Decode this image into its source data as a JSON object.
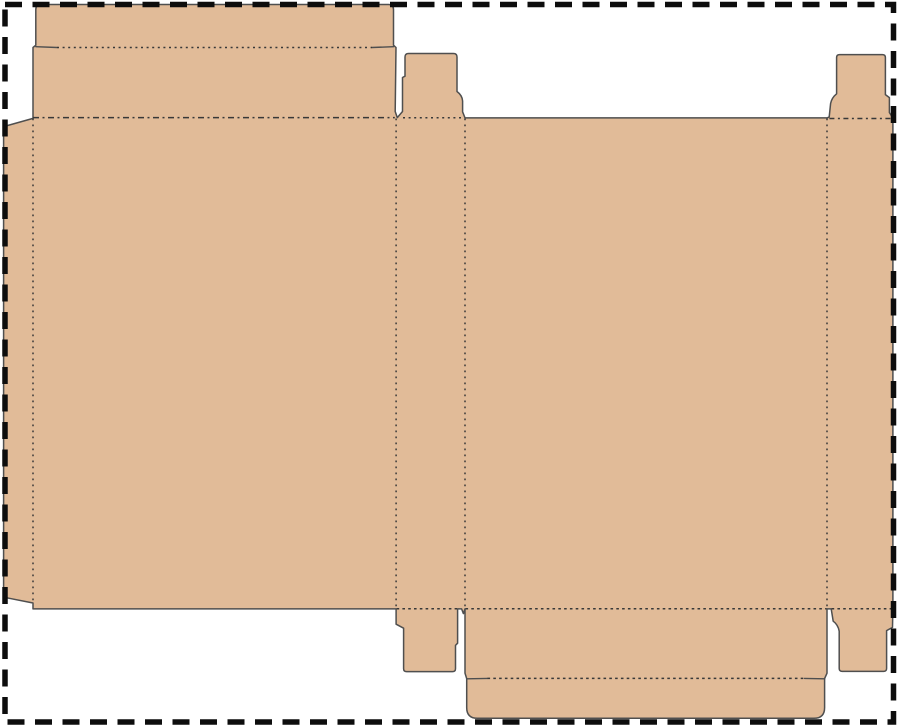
{
  "diagram": {
    "name": "folding-carton-dieline-template",
    "canvas": {
      "width": 900,
      "height": 727,
      "background": "#ffffff"
    },
    "colors": {
      "board_fill": "#E1BB98",
      "cut_line": "#4f4f4f",
      "crease_line": "#383838",
      "page_border": "#0d0d0d"
    },
    "page_border": {
      "x": 5,
      "y": 4.5,
      "width": 888.5,
      "height": 717.5,
      "stroke_width": 5.5,
      "dash": "17 10.5"
    },
    "outline": {
      "name": "dieline-cut-outline",
      "path": "M33,47.5 L35.8,45.2 L35.8,9.5 Q35.8,4.5 40.8,4.5 L388.5,4.5 Q393.5,4.5 393.5,9.5 L393.5,45.2 L396,47.5 L395.2,111.5 L397.3,117.6 L402.5,111.5 L402.5,77.5 L405,76.2 L405,57 Q405,53.5 408.5,53.5 L453.5,53.5 Q457,53.5 457,57 L457,91.5 Q462.3,95.4 462.6,101 L462.6,111.8 L465,117.9 L827,117.9 L829.2,117 L830.6,103.5 Q831.8,97.6 836.6,93.8 L836.6,57.5 Q836.6,54.6 839.6,54.6 L882.4,54.6 Q885.4,54.6 885.4,57.5 L885.4,94.6 L889.4,97.6 L889.4,112.6 L892.9,117.9 L892.9,607.6 L892.5,627.4 L886.6,630.6 L886.6,668.4 Q886.6,671.4 883.6,671.4 L842.2,671.4 Q839.2,671.4 839.2,668.4 L839.2,631.2 Q838,624.6 833.2,621.2 L831.2,608.9 L827,608.9 L827,673.2 L824.6,678.6 L824.6,707.6 Q824.6,718.3 813.9,718.3 L477.4,718.3 Q466.7,718.3 466.7,707.6 L466.7,678.6 L465,673.2 L465,608.9 L463.4,613.6 L461.6,608.9 L457.6,608.9 L457.6,643.2 L455.5,645.4 L455.5,668.6 Q455.5,671.6 452.5,671.6 L406.6,671.6 Q403.6,671.6 403.6,668.6 L403.6,628.2 L396.1,624.2 L396.1,608.9 L33,608.9 L33,603 L3.6,597.2 L3.6,126.6 L33,118.4 Z"
    },
    "solid_stubs": [
      {
        "name": "crease-stub-top-left",
        "path": "M35.8,46.7 L57,47.5"
      },
      {
        "name": "crease-stub-top-right",
        "path": "M372,47.5 L393.5,46.7"
      },
      {
        "name": "crease-stub-tuck-left",
        "path": "M466.7,678.8 L487.5,678.4"
      },
      {
        "name": "crease-stub-tuck-right",
        "path": "M804.5,678.4 L824.6,678.8"
      }
    ],
    "crease_lines": [
      {
        "name": "crease-top-tuck-flap",
        "path": "M57,47.5 L372,47.5",
        "dash": "2 3.6"
      },
      {
        "name": "crease-top-seal-flap",
        "path": "M33,117.6 L394.8,117.6",
        "dash": "6 3.5 2 3.5"
      },
      {
        "name": "crease-top-middle-tab",
        "path": "M403,117.7 L462,117.7",
        "dash": "2 3.6"
      },
      {
        "name": "crease-top-right-tab",
        "path": "M829.4,118.5 L891,118.5",
        "dash": "5 3.5 2 3.5"
      },
      {
        "name": "crease-left-glue-flap",
        "path": "M33,118.5 L33,602.6",
        "dash": "1.8 4.2"
      },
      {
        "name": "crease-strip-left",
        "path": "M396.1,118.5 L396.1,608.4",
        "dash": "1.8 4.2"
      },
      {
        "name": "crease-strip-right",
        "path": "M465,118.5 L465,608.4",
        "dash": "1.8 4.2"
      },
      {
        "name": "crease-right-strip",
        "path": "M827,118.5 L827,608.4",
        "dash": "1.8 4.2"
      },
      {
        "name": "crease-bottom-middle-tab",
        "path": "M396.6,608.7 L457.1,608.7",
        "dash": "2.6 3.2"
      },
      {
        "name": "crease-bottom-flap",
        "path": "M465.5,608.7 L826.5,608.7",
        "dash": "2.6 3.2"
      },
      {
        "name": "crease-bottom-right-tab",
        "path": "M831.6,608.7 L892.4,608.7",
        "dash": "2.6 3.2"
      },
      {
        "name": "crease-bottom-tuck-flap",
        "path": "M487.5,678.4 L804.5,678.4",
        "dash": "2.6 3.2"
      }
    ],
    "regions": [
      {
        "name": "region-top-tuck-flap",
        "x": 35.8,
        "y": 4.5,
        "w": 357.7,
        "h": 43
      },
      {
        "name": "region-top-seal-flap",
        "x": 33,
        "y": 47.5,
        "w": 363,
        "h": 70
      },
      {
        "name": "region-top-middle-tab",
        "x": 402.5,
        "y": 53.5,
        "w": 60,
        "h": 64
      },
      {
        "name": "region-top-right-tab",
        "x": 829,
        "y": 54.6,
        "w": 62,
        "h": 63
      },
      {
        "name": "region-left-glue-flap",
        "x": 3.6,
        "y": 118.4,
        "w": 29.4,
        "h": 484
      },
      {
        "name": "region-front-panel",
        "x": 33,
        "y": 117.6,
        "w": 363,
        "h": 491
      },
      {
        "name": "region-side-panel-middle",
        "x": 396.1,
        "y": 117.7,
        "w": 68.9,
        "h": 491
      },
      {
        "name": "region-back-panel",
        "x": 465,
        "y": 117.9,
        "w": 362,
        "h": 491
      },
      {
        "name": "region-side-strip-right",
        "x": 827,
        "y": 117.9,
        "w": 65.9,
        "h": 490.8
      },
      {
        "name": "region-bottom-middle-tab",
        "x": 396.1,
        "y": 608.9,
        "w": 61.5,
        "h": 62.7
      },
      {
        "name": "region-bottom-right-tab",
        "x": 831.2,
        "y": 608.9,
        "w": 61.7,
        "h": 62.5
      },
      {
        "name": "region-bottom-flap",
        "x": 465,
        "y": 608.9,
        "w": 362,
        "h": 69.7
      },
      {
        "name": "region-bottom-tuck-flap",
        "x": 466.7,
        "y": 678.6,
        "w": 357.9,
        "h": 39.7
      }
    ]
  }
}
